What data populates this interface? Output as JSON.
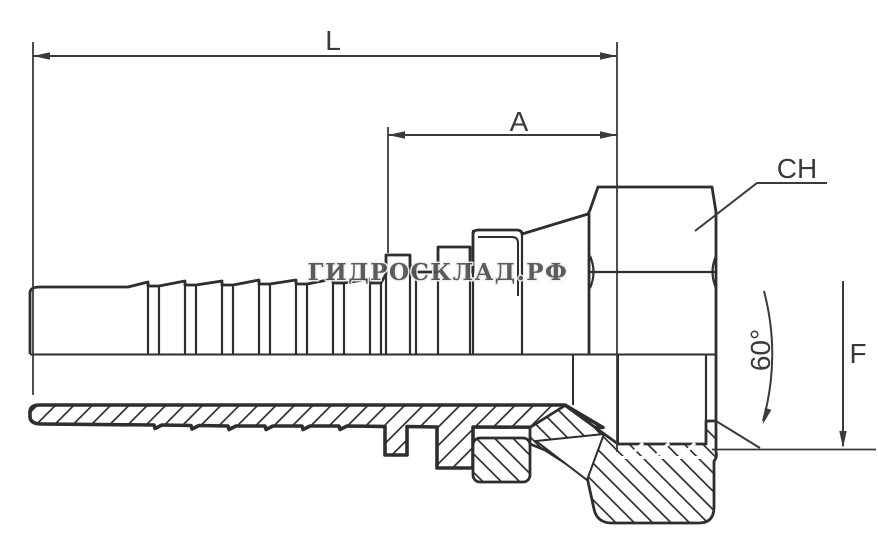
{
  "drawing": {
    "type": "technical-drawing",
    "subject": "hydraulic hose fitting with female thread, barbed nipple, hex nut and 60-degree cone seat",
    "watermark": "ГИДРОСКЛАД.РФ",
    "labels": {
      "overall_length": "L",
      "thread_length": "A",
      "hex_size": "CH",
      "thread_size": "F",
      "cone_angle": "60°"
    },
    "colors": {
      "line": "#2e2e2e",
      "label": "#3a3a3a",
      "background": "#ffffff",
      "watermark_fill": "#4f4f4f"
    }
  }
}
